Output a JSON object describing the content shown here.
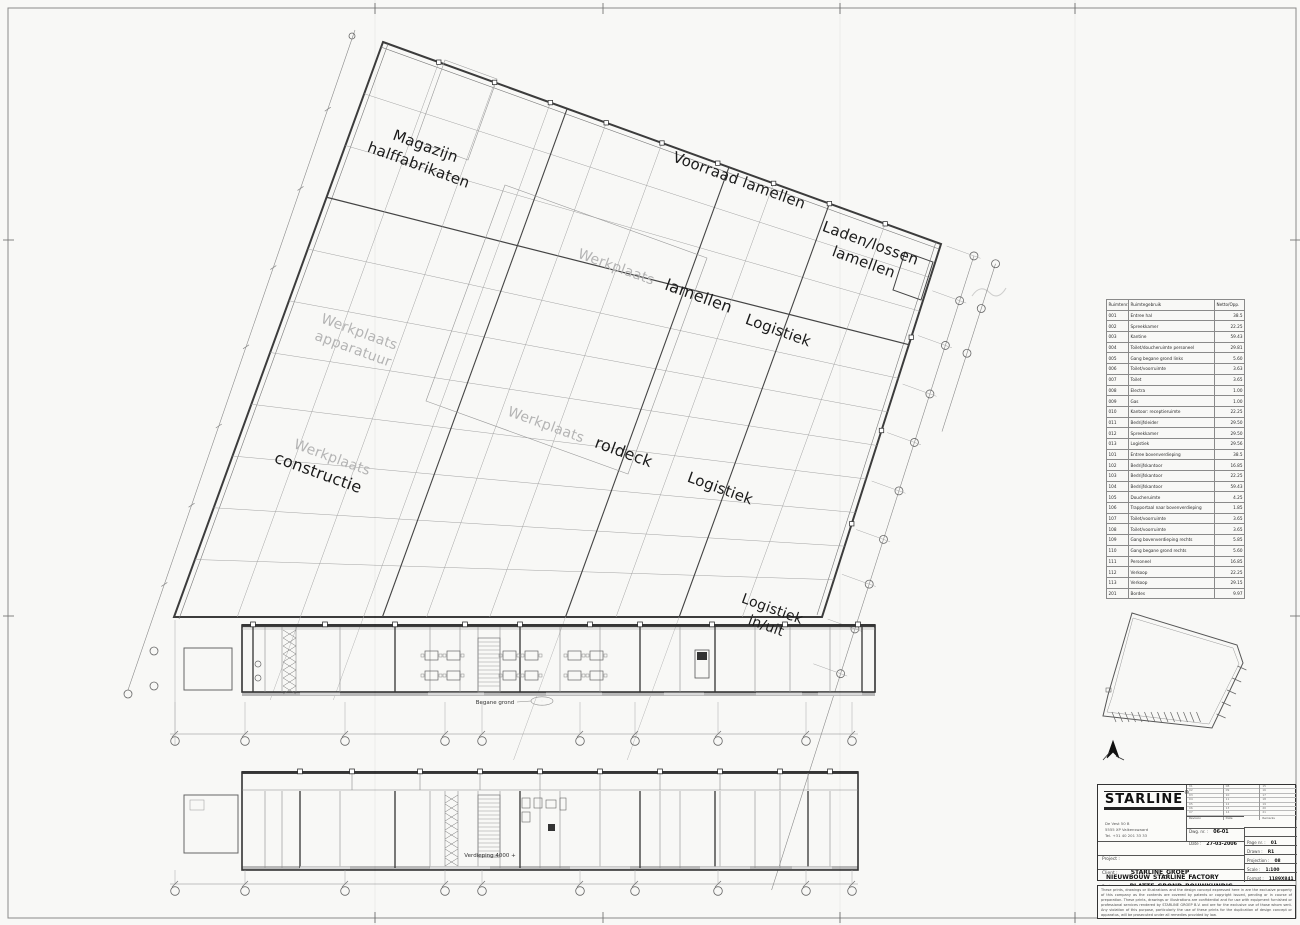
{
  "plan": {
    "areas": {
      "magazijn": {
        "line1": "Magazijn",
        "line2": "halffabrikaten"
      },
      "voorraad": {
        "text": "Voorraad lamellen"
      },
      "laden_lossen": {
        "line1": "Laden/lossen",
        "line2": "lamellen"
      },
      "werkplaats_lamellen": {
        "muted": "Werkplaats",
        "main": "lamellen"
      },
      "werkplaats_apparatuur": {
        "line1": "Werkplaats",
        "line2": "apparatuur"
      },
      "werkplaats_roldeck": {
        "muted": "Werkplaats",
        "main": "roldeck"
      },
      "werkplaats_constructie": {
        "muted": "Werkplaats",
        "main": "constructie"
      },
      "logistiek_noord": {
        "text": "Logistiek"
      },
      "logistiek_zuid": {
        "text": "Logistiek"
      },
      "logistiek_in_uit": {
        "line1": "Logistiek",
        "line2": "in/uit"
      }
    },
    "floor_labels": {
      "begane_grond": "Begane grond",
      "verdieping": "Verdieping 4000 +"
    }
  },
  "room_table": {
    "headers": [
      "Ruimtenr.",
      "Ruimtegebruik",
      "Netto/Opp."
    ],
    "rows": [
      [
        "001",
        "Entree hal",
        "38.5"
      ],
      [
        "002",
        "Spreekkamer",
        "22.25"
      ],
      [
        "003",
        "Kantine",
        "59.43"
      ],
      [
        "004",
        "Toilet/doucheruimte personeel",
        "29.81"
      ],
      [
        "005",
        "Gang begane grond links",
        "5.60"
      ],
      [
        "006",
        "Toilet/voorruimte",
        "3.63"
      ],
      [
        "007",
        "Toilet",
        "3.65"
      ],
      [
        "008",
        "Electra",
        "1.00"
      ],
      [
        "009",
        "Gas",
        "1.00"
      ],
      [
        "010",
        "Kantoor: receptieruimte",
        "22.25"
      ],
      [
        "011",
        "Bedrijfsleider",
        "29.50"
      ],
      [
        "012",
        "Spreekkamer",
        "29.50"
      ],
      [
        "013",
        "Logistiek",
        "29.56"
      ],
      [
        "101",
        "Entree bovenverdieping",
        "38.5"
      ],
      [
        "102",
        "Bedrijfskantoor",
        "16.85"
      ],
      [
        "103",
        "Bedrijfskantoor",
        "22.25"
      ],
      [
        "104",
        "Bedrijfskantoor",
        "59.43"
      ],
      [
        "105",
        "Doucheruimte",
        "4.25"
      ],
      [
        "106",
        "Trapportaal naar bovenverdieping",
        "1.85"
      ],
      [
        "107",
        "Toilet/voorruimte",
        "3.65"
      ],
      [
        "108",
        "Toilet/voorruimte",
        "3.65"
      ],
      [
        "109",
        "Gang bovenverdieping rechts",
        "5.85"
      ],
      [
        "110",
        "Gang begane grond rechts",
        "5.60"
      ],
      [
        "111",
        "Personeel",
        "16.85"
      ],
      [
        "112",
        "Verkoop",
        "22.25"
      ],
      [
        "113",
        "Verkoop",
        "29.15"
      ],
      [
        "201",
        "Bordes",
        "9.97"
      ]
    ]
  },
  "title_block": {
    "logo": "STARLINE",
    "reg": "®",
    "address": [
      "De Vest 50 B",
      "5555 XP Valkenswaard",
      "Tel.  +31 40 201 33 33"
    ],
    "rev_rows": [
      [
        "01",
        "08",
        "15"
      ],
      [
        "02",
        "09",
        "16"
      ],
      [
        "03",
        "10",
        "17"
      ],
      [
        "04",
        "11",
        "18"
      ],
      [
        "05",
        "12",
        "19"
      ],
      [
        "06",
        "13",
        "20"
      ],
      [
        "07",
        "14",
        "21"
      ]
    ],
    "rev_footer": [
      "Revision",
      "Date",
      "Remarks"
    ],
    "dwg_label": "Dwg. nr. :",
    "dwg": "06-01",
    "date_label": "Date :",
    "date": "27-03-2006",
    "page_label": "Page nr. :",
    "page": "01",
    "drawn_label": "Drawn :",
    "drawn": "R1",
    "projection_label": "Projection :",
    "projection": "08",
    "scale_label": "Scale :",
    "scale": "1:100",
    "format_label": "Format :",
    "format": "1189X841",
    "projectnr_label": "Project nr. :",
    "projectnr": "2006-108",
    "project_label": "Project :",
    "project": "NIEUWBOUW_STARLINE_FACTORY",
    "client_label": "Client :",
    "client": "STARLINE_GROEP",
    "part_label": "Part :",
    "part": "PLATTE_GROND_BOUWKUNDIG"
  },
  "disclaimer": "These prints, drawings or illustrations and the design concept expressed here in are the exclusive property of this company as the contents are covered by patents or copyright issued, pending or in course of preparation. These prints, drawings or illustrations are confidential and for use with equipment furnished or professional services rendered by STARLINE GROEP B.V. and are for the exclusive use of those whom sent. Any violation of this purpose, particularly the use of these prints for the duplication of design concept or apparatus, will be prosecuted under all remedies provided by law."
}
